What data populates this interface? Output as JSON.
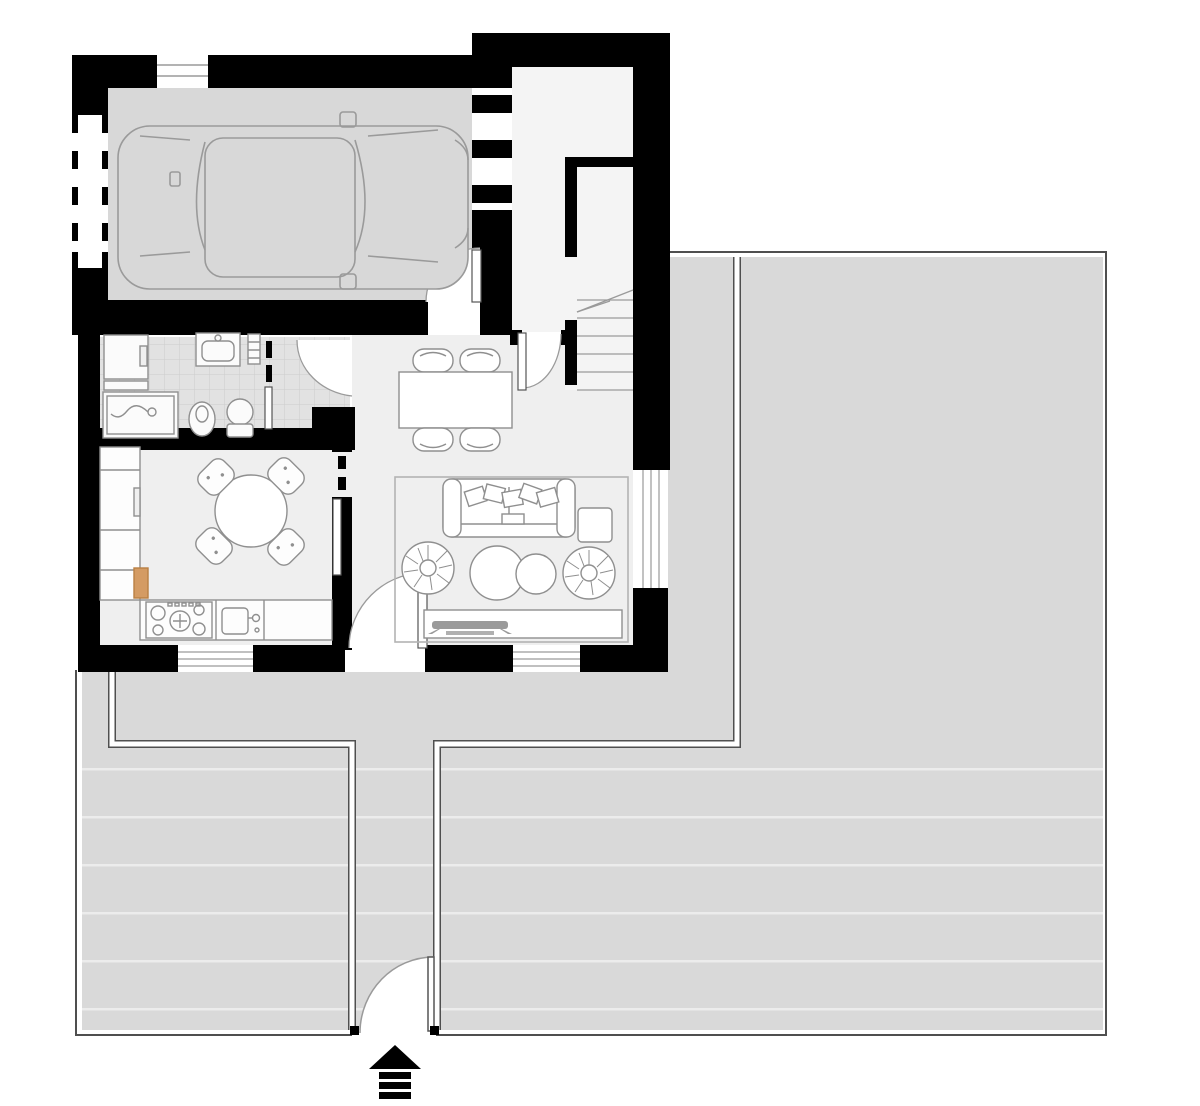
{
  "document": {
    "type": "architectural-floor-plan",
    "floor": "ground-floor-with-garden",
    "visible_text": [],
    "canvas": {
      "width": 1200,
      "height": 1106
    }
  },
  "colors": {
    "wall": "#000000",
    "garage_floor": "#d8d8d8",
    "interior_floor": "#efefef",
    "hall_floor": "#f4f4f4",
    "bathroom_tile": "#e2e2e2",
    "tile_grout": "#cccccc",
    "outdoor_paving": "#d9d9d9",
    "paving_stripe": "#ececec",
    "fence_line": "#4f4f4f",
    "furniture_outline": "#8f8f8f",
    "rug_outline": "#b3b3b3",
    "accent_wood": "#d49b63",
    "entrance_arrow": "#000000"
  },
  "rooms": [
    {
      "name": "garage",
      "contents": [
        "car-top-view",
        "garage-door-dashed-opening",
        "door-to-house"
      ]
    },
    {
      "name": "entry-vestibule",
      "contents": [
        "opening-to-garage-dashed",
        "front-door-arc"
      ]
    },
    {
      "name": "staircase",
      "contents": [
        "steps",
        "direction-line"
      ]
    },
    {
      "name": "bathroom",
      "contents": [
        "washing-machine",
        "shelf",
        "shower",
        "sink",
        "radiator",
        "bidet",
        "toilet",
        "pocket-door",
        "anteroom-door-arc"
      ]
    },
    {
      "name": "kitchen",
      "contents": [
        "tall-cabinets",
        "wood-board",
        "round-table",
        "four-chairs",
        "cooktop",
        "kitchen-sink",
        "window"
      ]
    },
    {
      "name": "living-room",
      "contents": [
        "dining-table",
        "four-dining-chairs",
        "rug",
        "sofa-with-pillows",
        "side-table",
        "pouf-left",
        "pouf-right",
        "coffee-tables",
        "tv-bench",
        "tv",
        "terrace-door",
        "windows"
      ]
    }
  ],
  "outdoor": {
    "areas": [
      "side-strip",
      "main-terrace",
      "rear-path",
      "striped-lawn-left",
      "walk-corridor"
    ],
    "fence": "thin double line around plot",
    "gate": "swing gate at bottom with quarter-circle arc",
    "entrance_marker": "black up-arrow with striped shaft"
  }
}
